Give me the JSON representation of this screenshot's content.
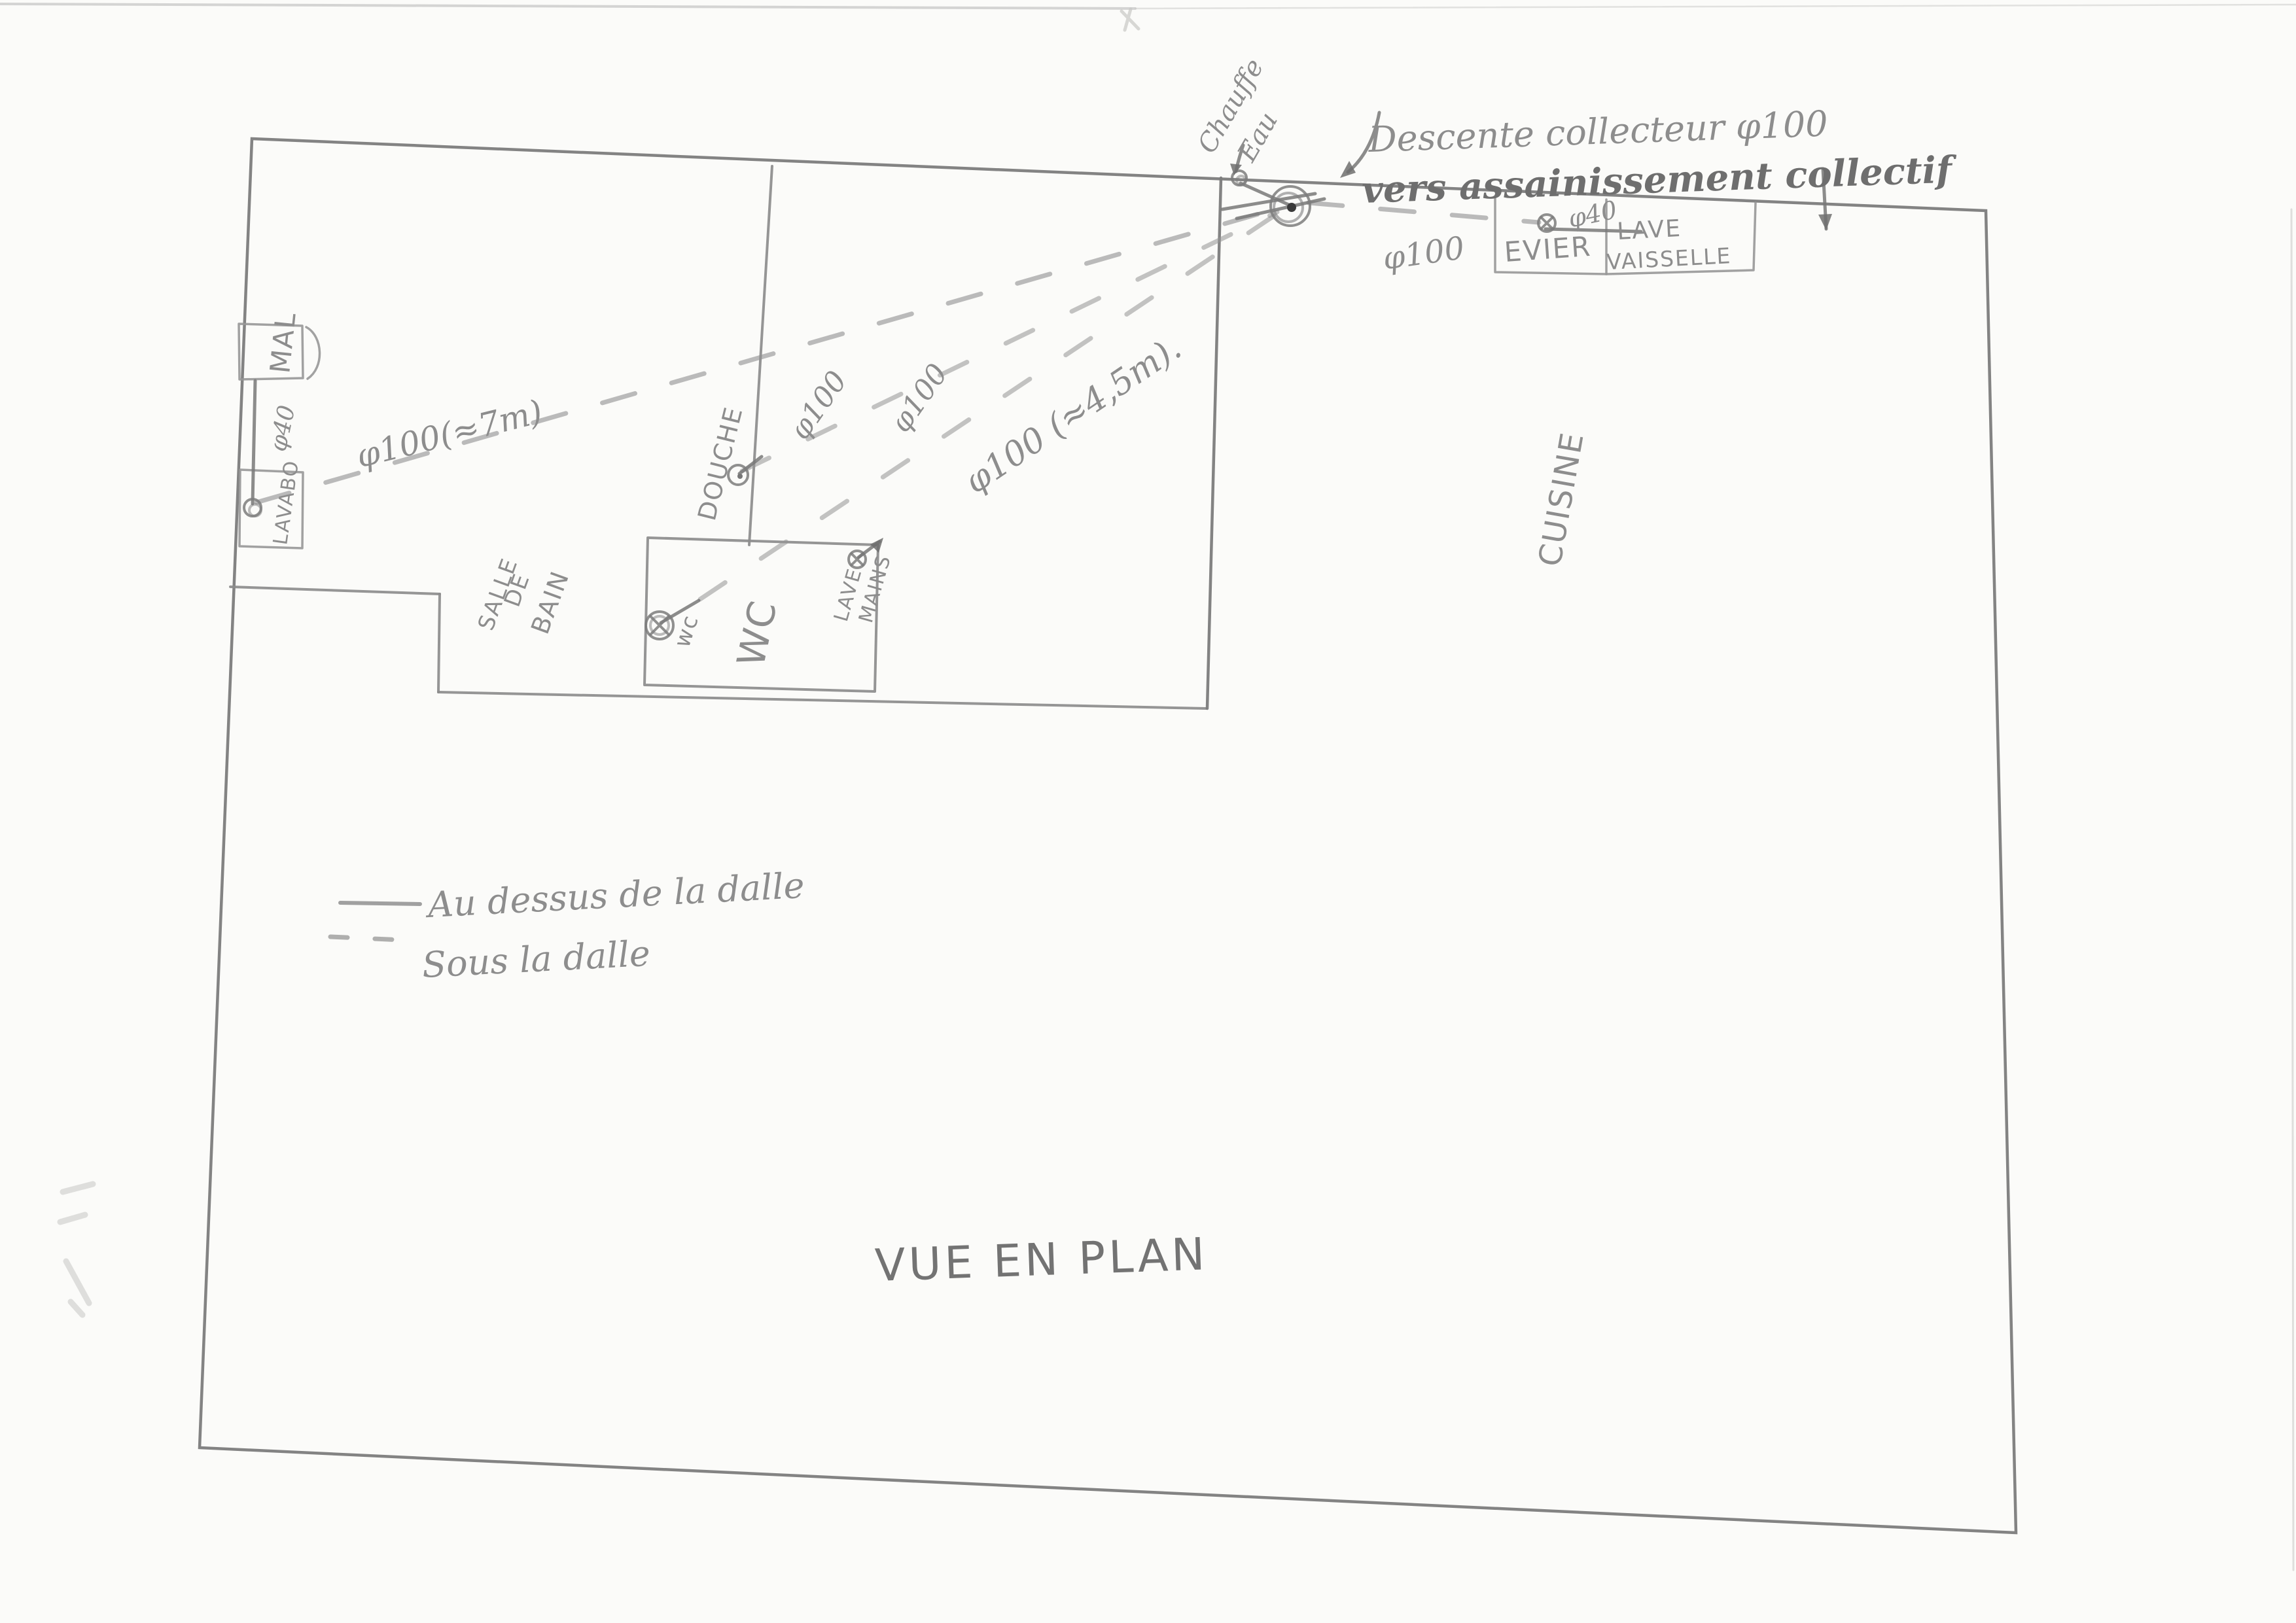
{
  "title": "VUE EN PLAN",
  "notes": {
    "collector1": "Descente collecteur φ100",
    "collector2": "vers assainissement collectif",
    "chauffe1": "Chauffe",
    "chauffe2": "Eau"
  },
  "rooms": {
    "salle1": "SALLE",
    "salle2": "DE",
    "salle3": "BAIN",
    "wc": "WC",
    "cuisine": "CUISINE"
  },
  "fixtures": {
    "mal": "MAL",
    "lavabo": "LAVABO",
    "douche": "DOUCHE",
    "wc_small": "wc",
    "lave": "LAVE",
    "mains": "MAINS",
    "evier": "EVIER",
    "lv1": "LAVE",
    "lv2": "VAISSELLE"
  },
  "pipes": {
    "phi40_left": "φ40",
    "run_lavabo": "φ100(≈7m)",
    "run_douche": "φ100",
    "run_wc": "φ100",
    "run_wc_len": "φ100 (≈4,5m).",
    "run_evier": "φ100",
    "phi40_evier": "φ40"
  },
  "legend": {
    "above": "Au dessus de la dalle",
    "below": "Sous la dalle"
  },
  "colors": {
    "pencil": "#8d8d8d",
    "pencil_dark": "#6e6e6e",
    "paper": "#fbfbf9"
  }
}
